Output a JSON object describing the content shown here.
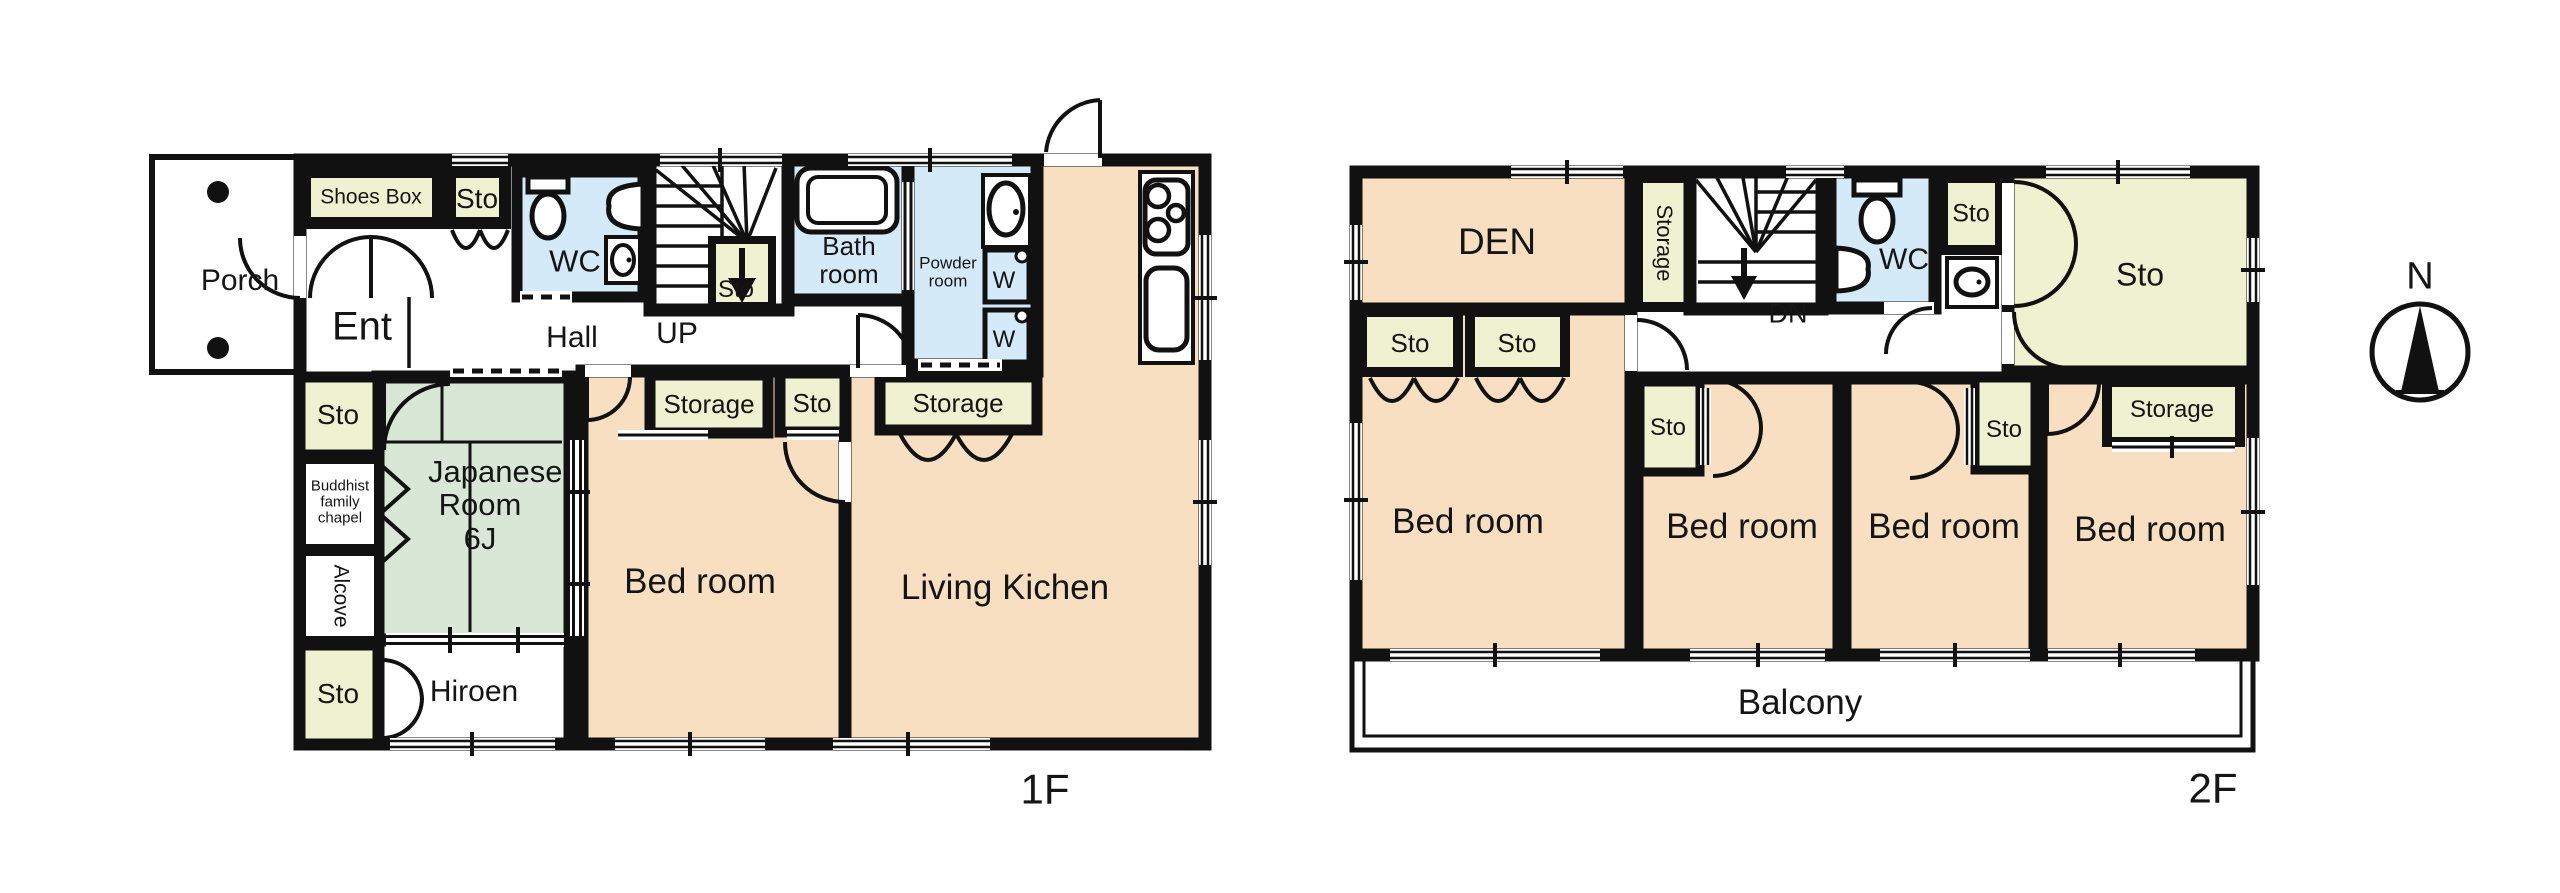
{
  "colors": {
    "wall": "#111111",
    "room": "#f9dfc2",
    "storage": "#eff2d0",
    "tatami": "#d9e7d7",
    "wet": "#d4eaf8",
    "paper": "#ffffff"
  },
  "floor1": {
    "floor_label": "1F",
    "labels": {
      "porch": "Porch",
      "shoes_box": "Shoes Box",
      "sto_entry": "Sto",
      "ent": "Ent",
      "wc": "WC",
      "hall": "Hall",
      "up": "UP",
      "sto_stairs": "Sto",
      "bath": "Bath room",
      "powder": "Powder room",
      "washer_top": "W",
      "washer_bottom": "W",
      "storage_bed": "Storage",
      "sto_bed": "Sto",
      "storage_living": "Storage",
      "sto_chapel": "Sto",
      "chapel": "Buddhist family chapel",
      "alcove": "Alcove",
      "japanese": "Japanese Room 6J",
      "sto_hiroen": "Sto",
      "hiroen": "Hiroen",
      "bedroom": "Bed room",
      "living": "Living Kichen"
    }
  },
  "floor2": {
    "floor_label": "2F",
    "labels": {
      "den": "DEN",
      "storage_stairs": "Storage",
      "dn": "DN",
      "wc": "WC",
      "sto_wc": "Sto",
      "sto_room": "Sto",
      "sto_den_1": "Sto",
      "sto_den_2": "Sto",
      "bed1": "Bed room",
      "sto_bed2": "Sto",
      "bed2": "Bed room",
      "bed3": "Bed room",
      "sto_bed3": "Sto",
      "storage_bed4": "Storage",
      "bed4": "Bed room",
      "balcony": "Balcony"
    }
  },
  "compass": {
    "north": "N"
  }
}
